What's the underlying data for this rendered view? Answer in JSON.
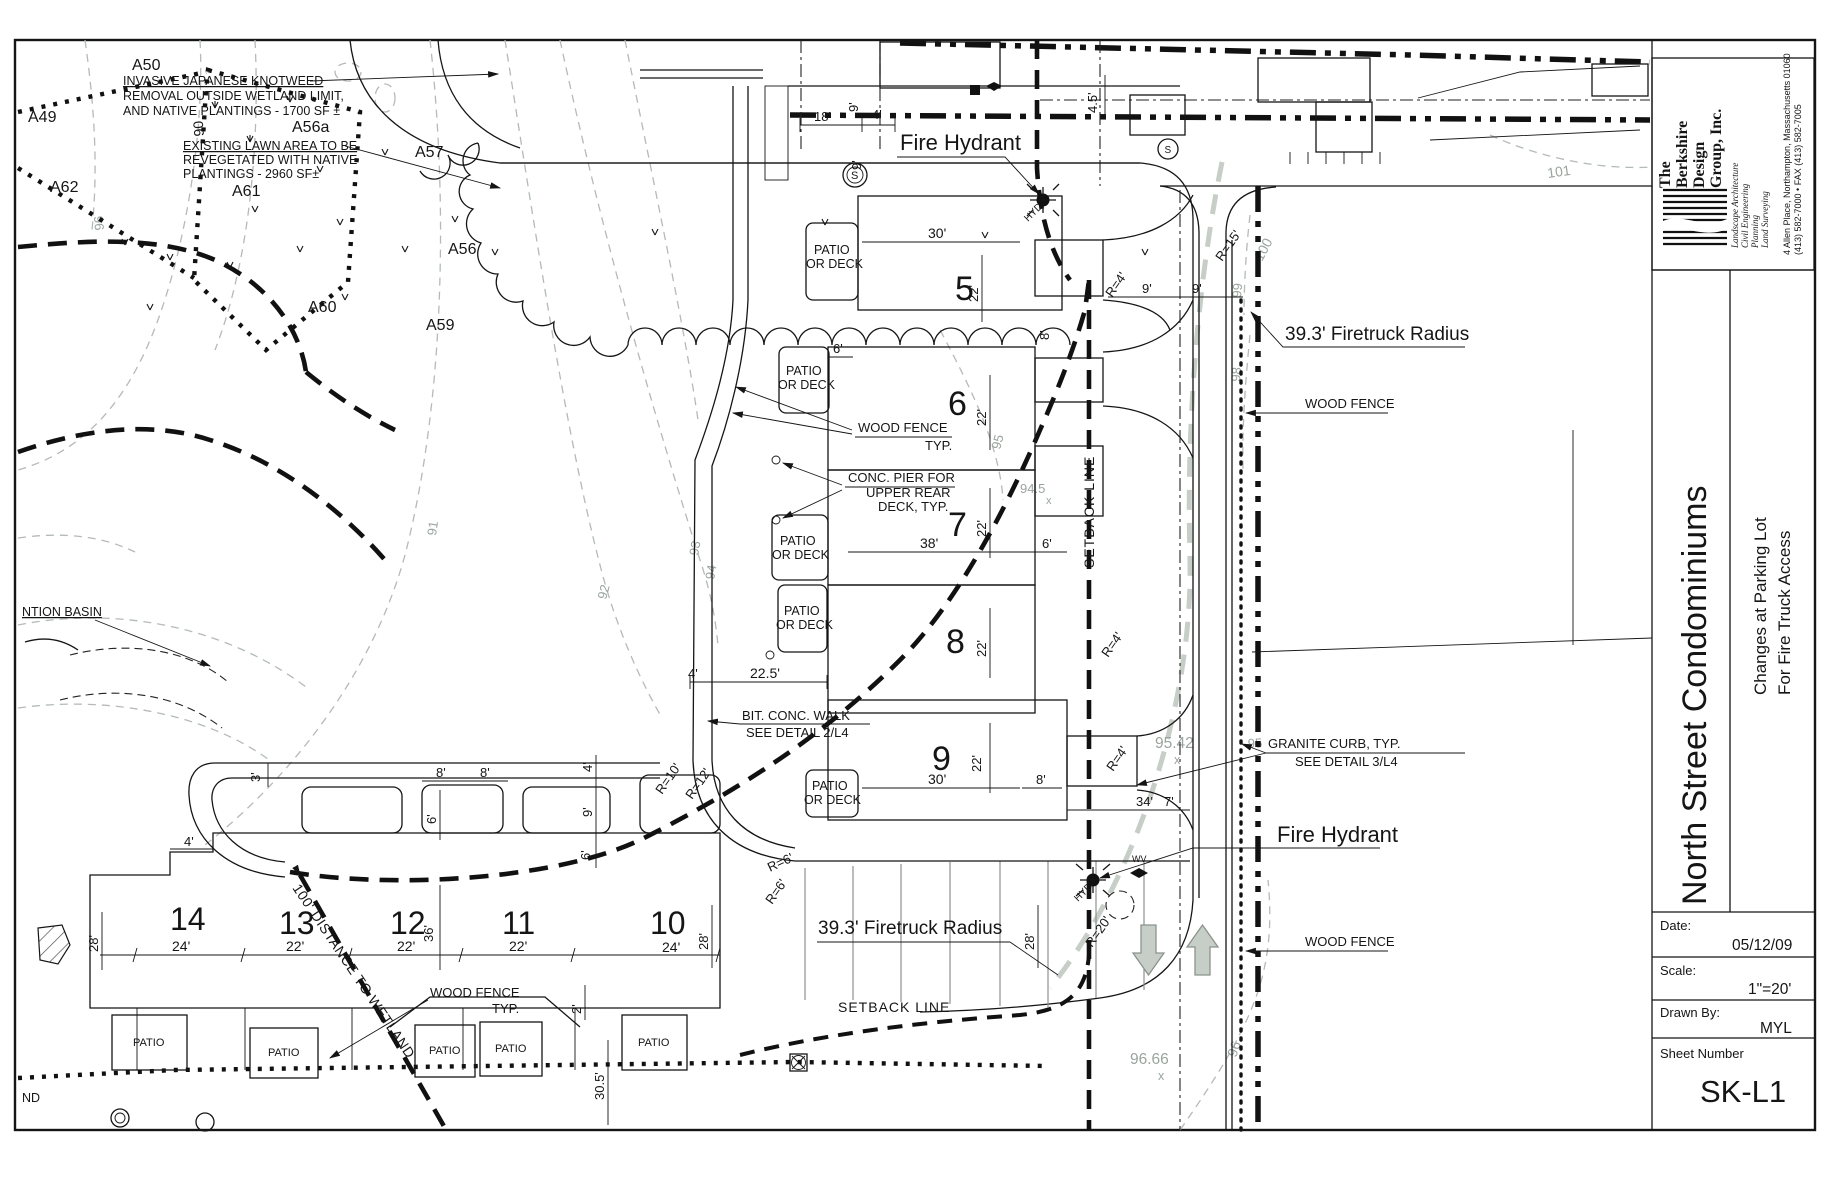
{
  "sheet": {
    "firm": {
      "line1": "The",
      "line2": "Berkshire",
      "line3": "Design",
      "line4": "Group, Inc.",
      "svc1": "Landscape Architecture",
      "svc2": "Civil Engineering",
      "svc3": "Planning",
      "svc4": "Land Surveying",
      "addr1": "4 Allen Place,  Northampton,  Massachusetts  01060",
      "addr2": "(413) 582-7000  •  FAX (413) 582-7005"
    },
    "project_title": "North Street Condominiums",
    "sheet_title1": "Changes at Parking Lot",
    "sheet_title2": "For Fire Truck Access",
    "date_label": "Date:",
    "date": "05/12/09",
    "scale_label": "Scale:",
    "scale": "1\"=20'",
    "drawn_label": "Drawn  By:",
    "drawn": "MYL",
    "sheetno_label": "Sheet  Number",
    "sheetno": "SK-L1"
  },
  "notes": {
    "knotweed1": "INVASIVE JAPANESE KNOTWEED",
    "knotweed2": "REMOVAL OUTSIDE WETLAND LIMIT,",
    "knotweed3": "AND NATIVE PLANTINGS - 1700 SF ±",
    "lawn1": "EXISTING LAWN AREA TO BE",
    "lawn2": "REVEGETATED WITH NATIVE",
    "lawn3": "PLANTINGS - 2960 SF±"
  },
  "labels": {
    "fire_hydrant": "Fire Hydrant",
    "firetruck_radius": "39.3' Firetruck Radius",
    "wood_fence": "WOOD FENCE",
    "typ": "TYP.",
    "conc_pier1": "CONC. PIER FOR",
    "conc_pier2": "UPPER REAR",
    "conc_pier3": "DECK, TYP.",
    "bit_walk1": "BIT. CONC. WALK",
    "bit_walk2": "SEE DETAIL 2/L4",
    "granite1": "GRANITE CURB, TYP.",
    "granite2": "SEE DETAIL 3/L4",
    "setback": "SETBACK LINE",
    "patio": "PATIO",
    "or_deck": "OR DECK",
    "wetland_distance": "100' DISTANCE TO WETLAND",
    "basin": "NTION BASIN",
    "nd": "ND",
    "hyd": "HYD",
    "wv": "WV",
    "s": "S"
  },
  "units": {
    "u5": "5",
    "u6": "6",
    "u7": "7",
    "u8": "8",
    "u9": "9",
    "u10": "10",
    "u11": "11",
    "u12": "12",
    "u13": "13",
    "u14": "14"
  },
  "points": {
    "a49": "A49",
    "a50": "A50",
    "a56": "A56",
    "a56a": "A56a",
    "a57": "A57",
    "a59": "A59",
    "a60": "A60",
    "a61": "A61",
    "a62": "A62"
  },
  "contours": {
    "c90": "90",
    "c91": "91",
    "c92": "92",
    "c93": "93",
    "c94": "94",
    "c95": "95",
    "c96": "96",
    "c98": "98",
    "c99": "99",
    "c100": "100",
    "c101": "101"
  },
  "elev": {
    "e945": "94.5",
    "e9542": "95.42",
    "e9666": "96.66",
    "x": "x"
  },
  "dims": {
    "d2": "2'",
    "d3": "3'",
    "d4": "4'",
    "d45": "4.5'",
    "d6": "6'",
    "d7": "7'",
    "d8": "8'",
    "d9": "9'",
    "d18": "18'",
    "d22": "22'",
    "d225": "22.5'",
    "d24": "24'",
    "d28": "28'",
    "d30": "30'",
    "d305": "30.5'",
    "d34": "34'",
    "d36": "36'",
    "d38": "38'",
    "r4": "R=4'",
    "r6": "R=6'",
    "r10": "R=10'",
    "r12": "R=12'",
    "r15": "R=15'",
    "r20": "R=20'"
  }
}
